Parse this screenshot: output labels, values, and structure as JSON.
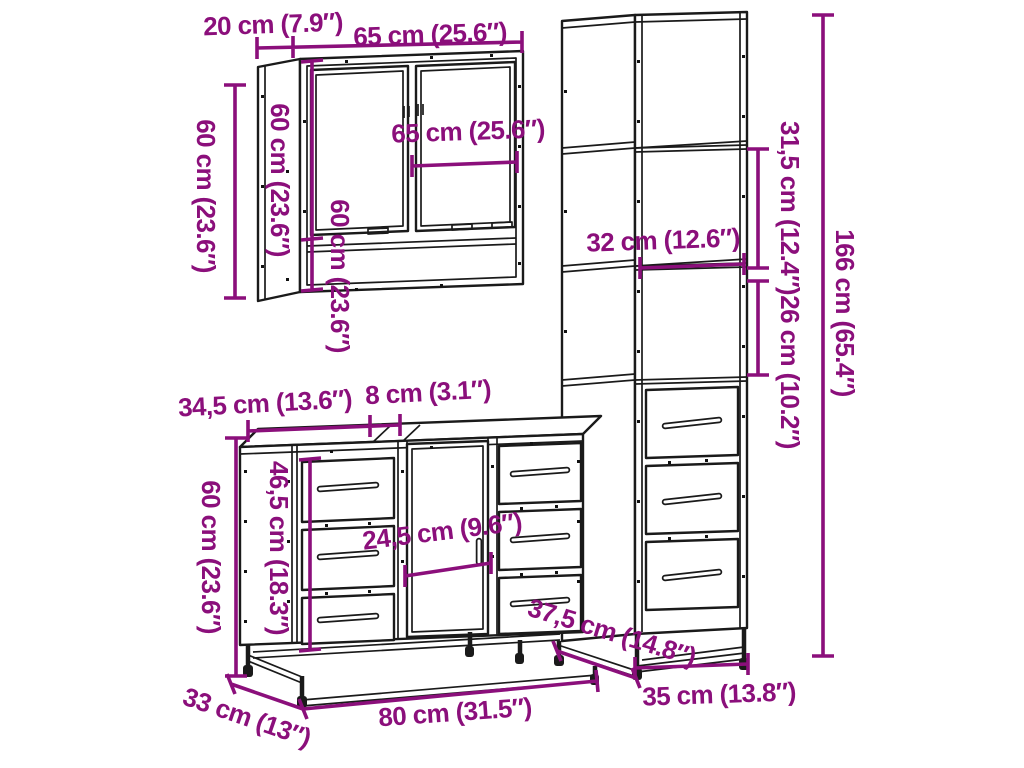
{
  "colors": {
    "dimension_accent": "#8B0F7B",
    "line_art": "#1A1A1A",
    "background": "#FFFFFF"
  },
  "mirror_cabinet": {
    "depth_label": "20 cm (7.9″)",
    "width_label": "65 cm (25.6″)",
    "height_label": "60 cm (23.6″)",
    "side_height_label": "60 cm (23.6″)",
    "inner_width_label": "65 cm (25.6″)",
    "inner_height_label": "60 cm (23.6″)"
  },
  "tall_cabinet": {
    "height_label": "166 cm (65.4″)",
    "upper_compartment_label": "31,5 cm (12.4″)",
    "shelf_width_label": "32 cm (12.6″)",
    "lower_compartment_label": "26 cm (10.2″)",
    "depth_label": "37,5 cm (14.8″)",
    "width_label": "35 cm (13.8″)"
  },
  "vanity_cabinet": {
    "top_left_label": "34,5 cm (13.6″)",
    "top_gap_label": "8 cm (3.1″)",
    "height_label": "60 cm (23.6″)",
    "inner_height_label": "46,5 cm (18.3″)",
    "door_width_label": "24,5 cm (9.6″)",
    "depth_label": "33 cm (13″)",
    "width_label": "80 cm (31.5″)"
  }
}
